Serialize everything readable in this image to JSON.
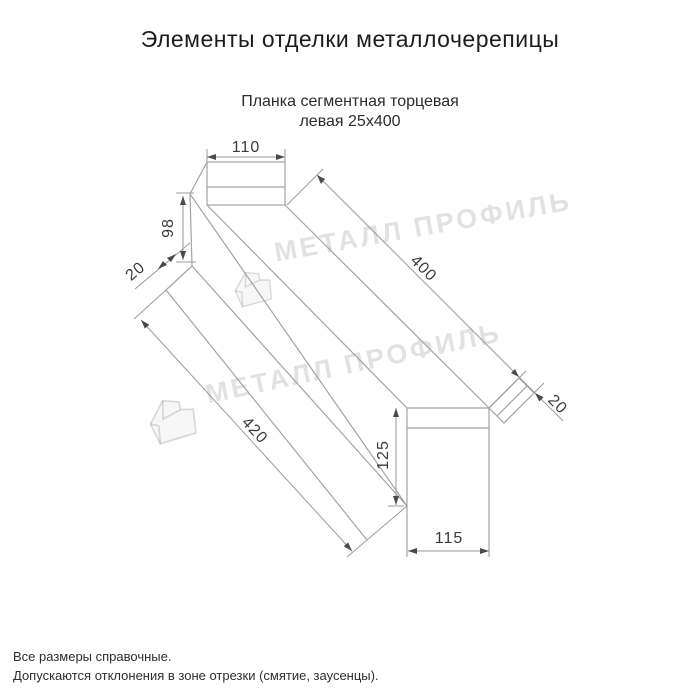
{
  "title": "Элементы отделки металлочерепицы",
  "subtitle": {
    "line1": "Планка сегментная торцевая",
    "line2": "левая 25х400"
  },
  "dimensions": {
    "top_flange_width": "110",
    "left_face_height": "98",
    "left_hem": "20",
    "length_outer": "400",
    "end_fold": "20",
    "length_inner": "420",
    "right_face_height": "125",
    "right_face_width": "115"
  },
  "watermark": {
    "text": "МЕТАЛЛ ПРОФИЛЬ"
  },
  "footer": {
    "note1": "Все размеры справочные.",
    "note2": "Допускаются отклонения в зоне отрезки (смятие, заусенцы)."
  },
  "colors": {
    "drawing_line": "#a3a3a3",
    "dimension_line": "#9a9a9a",
    "arrow": "#4a4a4a",
    "dim_text": "#3a3a3a",
    "title_text": "#1c1c1c",
    "watermark": "#c9c9c9"
  }
}
